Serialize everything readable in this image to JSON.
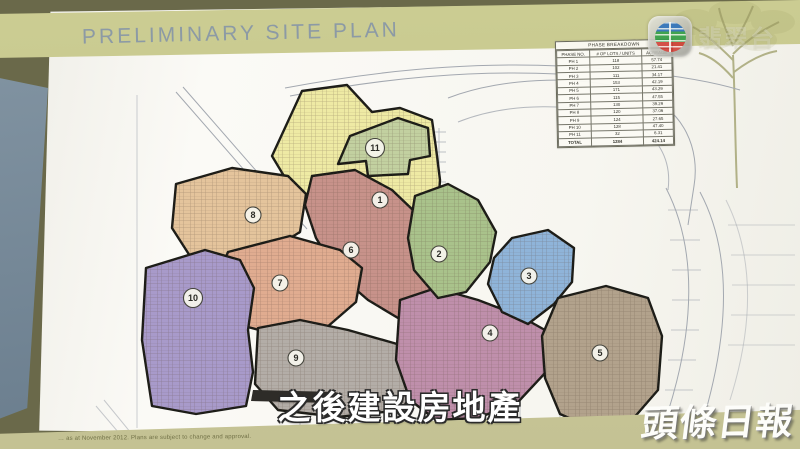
{
  "broadcast": {
    "channel_logo": "TVB",
    "channel_name": "翡翠台",
    "subtitle": "之後建設房地產",
    "press_watermark": "頭條日報"
  },
  "document": {
    "title": "PRELIMINARY SITE PLAN",
    "disclaimer": "… as at November 2012. Plans are subject to change and approval.",
    "header_band_color": "#c6c78e",
    "table": {
      "title": "PHASE BREAKDOWN",
      "columns": [
        "PHASE NO.",
        "# OF LOTS / UNITS",
        "ACREAGE"
      ],
      "rows": [
        [
          "PH 1",
          "118",
          "57.74"
        ],
        [
          "PH 2",
          "102",
          "21.41"
        ],
        [
          "PH 3",
          "111",
          "34.17"
        ],
        [
          "PH 4",
          "153",
          "42.19"
        ],
        [
          "PH 5",
          "171",
          "43.29"
        ],
        [
          "PH 6",
          "115",
          "47.55"
        ],
        [
          "PH 7",
          "130",
          "39.29"
        ],
        [
          "PH 8",
          "120",
          "37.06"
        ],
        [
          "PH 9",
          "124",
          "27.65"
        ],
        [
          "PH 10",
          "128",
          "47.40"
        ],
        [
          "PH 11",
          "32",
          "6.31"
        ]
      ],
      "total_row": [
        "TOTAL",
        "1284",
        "424.14"
      ]
    },
    "phases": [
      {
        "no": "1",
        "color": "#eeeaa4"
      },
      {
        "no": "2",
        "color": "#a9c28b"
      },
      {
        "no": "3",
        "color": "#8fb4d9"
      },
      {
        "no": "4",
        "color": "#bf8fab"
      },
      {
        "no": "5",
        "color": "#b2a28c"
      },
      {
        "no": "6",
        "color": "#c7928a"
      },
      {
        "no": "7",
        "color": "#e0ac90"
      },
      {
        "no": "8",
        "color": "#e4c49c"
      },
      {
        "no": "9",
        "color": "#b3ada7"
      },
      {
        "no": "10",
        "color": "#a89aca"
      },
      {
        "no": "11",
        "color": "#c2d0a0"
      }
    ]
  }
}
